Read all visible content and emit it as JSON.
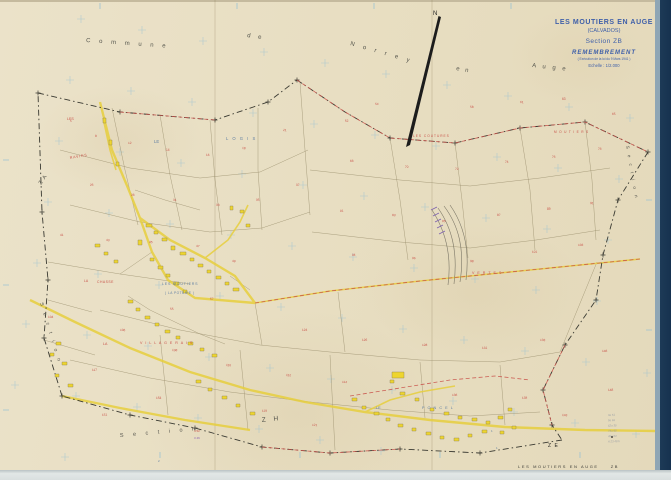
{
  "title_block": {
    "line1": "LES MOUTIERS EN AUGE",
    "line2": "(CALVADOS)",
    "line3": "Section ZB",
    "line4": "REMEMBREMENT",
    "line5": "( Exécution de la loi du 9 Mars 1941 )",
    "line6": "Echelle : 1/2.000"
  },
  "footer": {
    "commune": "LES  MOUTIERS  EN  AUGE",
    "section": "ZB"
  },
  "colors": {
    "paper": "#e9e0c6",
    "navy": "#16324f",
    "road": "#e7cf3e",
    "bldg": "#eed52e",
    "red": "#c9524a",
    "blue": "#6280a3",
    "ink": "#54544c",
    "title": "#3e5fa9",
    "pline": "#9a8f6d",
    "grat": "#9cc2d2",
    "purple": "#8b5fb0",
    "black": "#222220",
    "grey": "#8a93a0"
  },
  "map_labels": [
    {
      "t": "N",
      "x": 433,
      "y": 15,
      "s": 6,
      "c": "black"
    },
    {
      "t": "C o m m u n e",
      "x": 86,
      "y": 42,
      "r": 4,
      "s": 6,
      "sp": 3.5,
      "c": "ink"
    },
    {
      "t": "d e",
      "x": 247,
      "y": 37,
      "r": 8,
      "s": 6,
      "sp": 3,
      "c": "ink"
    },
    {
      "t": "N o r r e y",
      "x": 350,
      "y": 45,
      "r": 16,
      "s": 6,
      "sp": 3.5,
      "c": "ink"
    },
    {
      "t": "e n",
      "x": 456,
      "y": 70,
      "r": 10,
      "s": 6,
      "sp": 2,
      "c": "ink"
    },
    {
      "t": "A u g e",
      "x": 532,
      "y": 67,
      "r": 6,
      "s": 6,
      "sp": 2.5,
      "c": "ink"
    },
    {
      "t": "S e c t i o n",
      "x": 40,
      "y": 303,
      "r": 73,
      "s": 5,
      "sp": 3,
      "c": "ink"
    },
    {
      "t": "Z A",
      "x": 41,
      "y": 185,
      "r": -55,
      "s": 5.5,
      "sp": 1,
      "c": "ink"
    },
    {
      "t": "S e c t i o n",
      "x": 626,
      "y": 146,
      "r": 80,
      "s": 4.5,
      "sp": 2.5,
      "c": "ink"
    },
    {
      "t": "S e c t i o n",
      "x": 120,
      "y": 437,
      "r": -5,
      "s": 5.5,
      "sp": 4,
      "c": "ink"
    },
    {
      "t": "Z H",
      "x": 262,
      "y": 422,
      "r": -6,
      "s": 6.5,
      "sp": 3,
      "c": "ink"
    },
    {
      "t": "Z E",
      "x": 548,
      "y": 447,
      "s": 5,
      "sp": 1,
      "c": "black"
    },
    {
      "t": "LE",
      "x": 154,
      "y": 143,
      "s": 4.2,
      "c": "blue"
    },
    {
      "t": "L O G I S",
      "x": 226,
      "y": 140,
      "s": 4.2,
      "sp": 1.5,
      "c": "blue"
    },
    {
      "t": "LES  MOUTIERS",
      "x": 162,
      "y": 285,
      "s": 3.6,
      "sp": 0.8,
      "c": "blue"
    },
    {
      "t": "( LA  POTERIE )",
      "x": 165,
      "y": 294,
      "s": 3.2,
      "sp": 0.5,
      "c": "blue"
    },
    {
      "t": "LE",
      "x": 376,
      "y": 409,
      "s": 3.8,
      "c": "blue"
    },
    {
      "t": "P O N C E L",
      "x": 422,
      "y": 409,
      "s": 3.8,
      "sp": 1,
      "c": "blue"
    },
    {
      "t": "LES",
      "x": 67,
      "y": 120,
      "s": 3.6,
      "c": "red"
    },
    {
      "t": "RAVINS",
      "x": 70,
      "y": 159,
      "r": -10,
      "s": 3.6,
      "sp": 0.8,
      "c": "red"
    },
    {
      "t": "LA",
      "x": 84,
      "y": 282,
      "s": 3.4,
      "c": "red"
    },
    {
      "t": "CHASSE",
      "x": 97,
      "y": 283,
      "s": 3.4,
      "sp": 0.5,
      "c": "red"
    },
    {
      "t": "LA",
      "x": 103,
      "y": 345,
      "s": 3.6,
      "c": "red"
    },
    {
      "t": "V I L L A G E R A I S",
      "x": 140,
      "y": 344,
      "s": 3.6,
      "sp": 1,
      "c": "red"
    },
    {
      "t": "V E R T E S",
      "x": 472,
      "y": 274,
      "s": 3.6,
      "sp": 1,
      "c": "red"
    },
    {
      "t": "M O U T I E R S",
      "x": 554,
      "y": 133,
      "s": 3.2,
      "sp": 0.8,
      "c": "red"
    },
    {
      "t": "LES  COUTURES",
      "x": 413,
      "y": 137,
      "s": 3.2,
      "sp": 1,
      "c": "red"
    },
    {
      "t": "1",
      "x": 491,
      "y": 432,
      "s": 3,
      "c": "blue"
    },
    {
      "t": "1",
      "x": 496,
      "y": 449,
      "s": 3,
      "c": "blue"
    },
    {
      "t": "2",
      "x": 158,
      "y": 462,
      "s": 3,
      "c": "blue"
    },
    {
      "t": "4 52",
      "x": 194,
      "y": 432,
      "s": 3,
      "c": "red"
    },
    {
      "t": "3 46",
      "x": 194,
      "y": 439,
      "s": 3,
      "c": "purple"
    }
  ],
  "annotations": {
    "metric_rows": [
      "3a 51",
      "9a 65",
      "62a 35",
      "74a 90",
      "45a 04",
      "A 23 48 b"
    ]
  },
  "parcel_numbers": [
    [
      70,
      122,
      "5"
    ],
    [
      95,
      137,
      "8"
    ],
    [
      128,
      144,
      "12"
    ],
    [
      166,
      151,
      "14"
    ],
    [
      206,
      156,
      "16"
    ],
    [
      242,
      149,
      "18"
    ],
    [
      283,
      131,
      "21"
    ],
    [
      90,
      186,
      "26"
    ],
    [
      131,
      196,
      "28"
    ],
    [
      173,
      201,
      "31"
    ],
    [
      216,
      206,
      "33"
    ],
    [
      256,
      201,
      "35"
    ],
    [
      296,
      186,
      "37"
    ],
    [
      60,
      236,
      "41"
    ],
    [
      106,
      241,
      "43"
    ],
    [
      149,
      243,
      "45"
    ],
    [
      196,
      247,
      "47"
    ],
    [
      232,
      262,
      "49"
    ],
    [
      345,
      122,
      "52"
    ],
    [
      375,
      105,
      "54"
    ],
    [
      470,
      108,
      "58"
    ],
    [
      520,
      103,
      "61"
    ],
    [
      562,
      100,
      "63"
    ],
    [
      612,
      115,
      "65"
    ],
    [
      350,
      162,
      "68"
    ],
    [
      405,
      168,
      "70"
    ],
    [
      455,
      170,
      "72"
    ],
    [
      505,
      163,
      "74"
    ],
    [
      552,
      158,
      "76"
    ],
    [
      598,
      150,
      "78"
    ],
    [
      340,
      212,
      "81"
    ],
    [
      392,
      216,
      "83"
    ],
    [
      442,
      222,
      "85"
    ],
    [
      497,
      216,
      "87"
    ],
    [
      547,
      210,
      "89"
    ],
    [
      590,
      204,
      "91"
    ],
    [
      352,
      256,
      "94"
    ],
    [
      412,
      259,
      "96"
    ],
    [
      470,
      262,
      "98"
    ],
    [
      532,
      253,
      "101"
    ],
    [
      578,
      246,
      "103"
    ],
    [
      48,
      318,
      "104"
    ],
    [
      120,
      331,
      "106"
    ],
    [
      172,
      351,
      "108"
    ],
    [
      226,
      366,
      "110"
    ],
    [
      286,
      376,
      "112"
    ],
    [
      342,
      383,
      "114"
    ],
    [
      92,
      371,
      "117"
    ],
    [
      262,
      412,
      "119"
    ],
    [
      312,
      426,
      "121"
    ],
    [
      302,
      331,
      "124"
    ],
    [
      362,
      341,
      "126"
    ],
    [
      422,
      346,
      "128"
    ],
    [
      482,
      349,
      "131"
    ],
    [
      540,
      341,
      "133"
    ],
    [
      452,
      396,
      "136"
    ],
    [
      522,
      399,
      "138"
    ],
    [
      562,
      416,
      "143"
    ],
    [
      602,
      352,
      "146"
    ],
    [
      608,
      391,
      "148"
    ],
    [
      102,
      416,
      "151"
    ],
    [
      156,
      399,
      "153"
    ],
    [
      170,
      310,
      "55"
    ],
    [
      210,
      300,
      "57"
    ]
  ]
}
